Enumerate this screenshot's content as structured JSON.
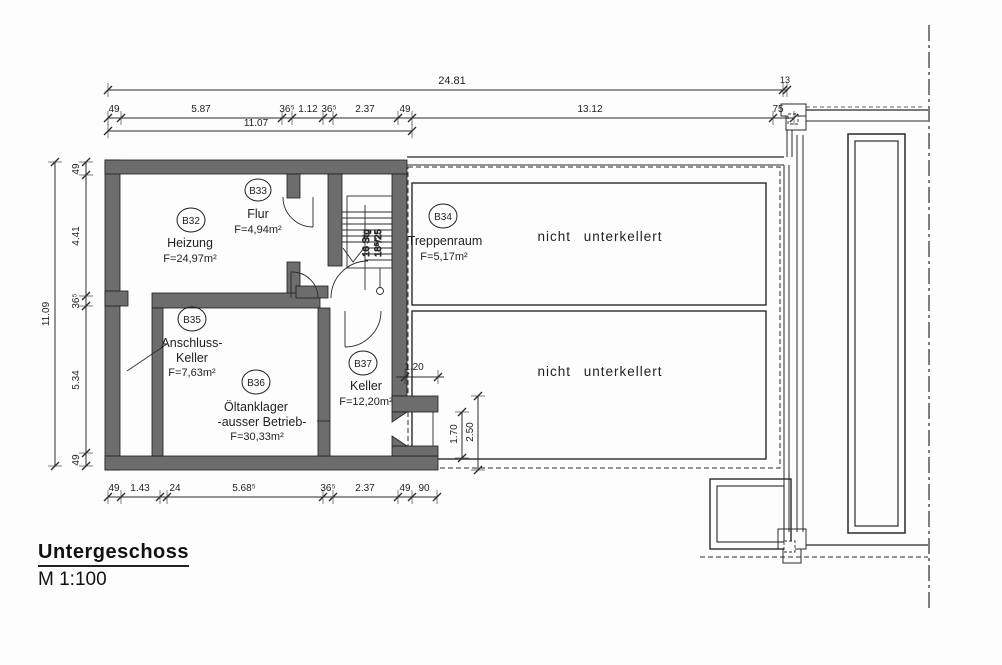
{
  "meta": {
    "title": "Untergeschoss",
    "scale": "M 1:100"
  },
  "rooms": [
    {
      "id": "B32",
      "name": "Heizung",
      "name2": "",
      "area": "F=24,97m²"
    },
    {
      "id": "B33",
      "name": "Flur",
      "name2": "",
      "area": "F=4,94m²"
    },
    {
      "id": "B34",
      "name": "Treppenraum",
      "name2": "",
      "area": "F=5,17m²"
    },
    {
      "id": "B35",
      "name": "Anschluss-",
      "name2": "Keller",
      "area": "F=7,63m²"
    },
    {
      "id": "B36",
      "name": "Öltanklager",
      "name2": "-ausser Betrieb-",
      "area": "F=30,33m²"
    },
    {
      "id": "B37",
      "name": "Keller",
      "name2": "",
      "area": "F=12,20m²"
    }
  ],
  "annotations": {
    "nicht_unterkellert_1": "nicht unterkellert",
    "nicht_unterkellert_2": "nicht unterkellert",
    "stair_steps": "16 Stg",
    "stair_ratio": "18⁵/25"
  },
  "dimensions": {
    "top_total": "24.81",
    "top_total_sub": "13",
    "top_row": [
      "49",
      "5.87",
      "36⁵",
      "1.12",
      "36⁵",
      "2.37",
      "49",
      "13.12",
      "75"
    ],
    "top_partial": "11.07",
    "left_total": "11.09",
    "left_row": [
      "49",
      "4.41",
      "36⁵",
      "5.34",
      "49"
    ],
    "bottom_row": [
      "49",
      "1.43",
      "24",
      "5.68⁵",
      "36⁵",
      "2.37",
      "49",
      "90"
    ],
    "detail": [
      "1.20",
      "1.70",
      "2.50"
    ]
  }
}
